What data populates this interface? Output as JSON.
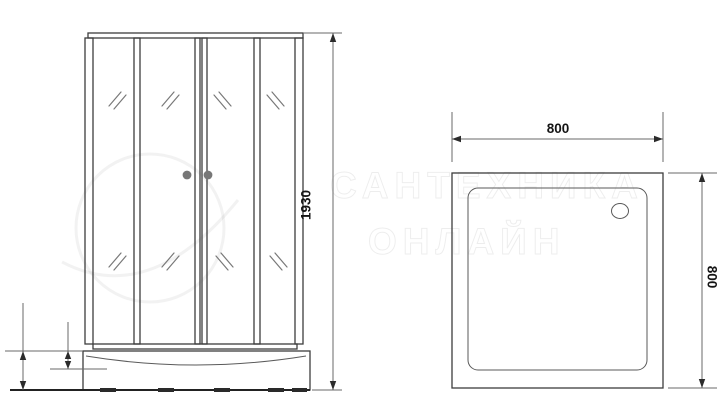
{
  "document": {
    "type": "technical-drawing",
    "subject": "shower-enclosure-dimension-drawing"
  },
  "colors": {
    "background": "#ffffff",
    "line": "#3d3d3d",
    "dim_text": "#141414",
    "handle": "#777777",
    "watermark": "rgba(0,0,0,0.07)"
  },
  "views": {
    "front": {
      "height_label": "1930"
    },
    "top": {
      "width_label": "800",
      "depth_label": "800"
    }
  },
  "watermark": {
    "line1": "САНТЕХНИКА",
    "line2": "ОНЛАЙН"
  }
}
